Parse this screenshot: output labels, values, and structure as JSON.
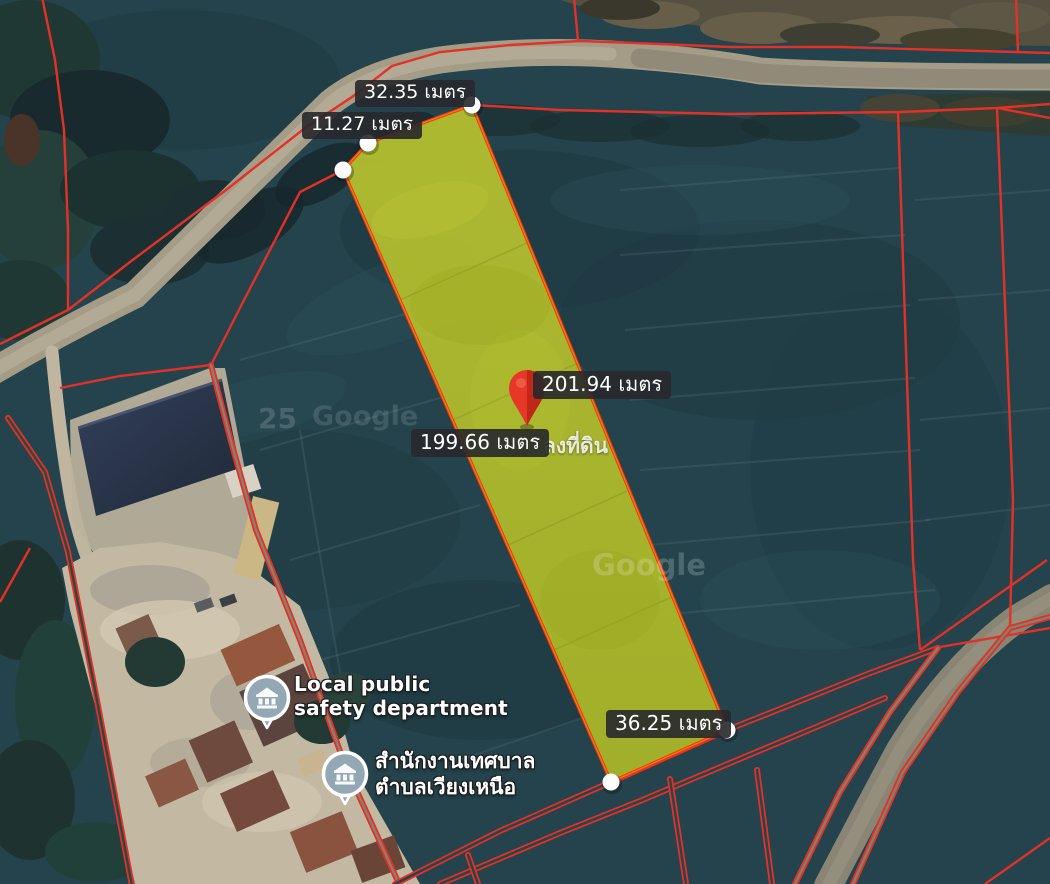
{
  "map": {
    "parcel": {
      "fill_color": "#adb92b",
      "border_color": "#ee3a13",
      "edge_labels": {
        "top": "32.35 เมตร",
        "top_left": "11.27 เมตร",
        "right": "201.94 เมตร",
        "left": "199.66 เมตร",
        "bottom": "36.25 เมตร"
      }
    },
    "marker": {
      "color": "#e73727"
    },
    "pois": [
      {
        "line1": "Local public",
        "line2": "safety department",
        "pin_color": "#93a7b4"
      },
      {
        "line1": "สำนักงานเทศบาล",
        "line2": "ตำบลเวียงเหนือ",
        "pin_color": "#93a7b4"
      }
    ],
    "watermarks": {
      "plot_text_partial": "ลงที่ดิน",
      "google": "Google",
      "year_fragment": "25"
    },
    "cadastral_line_color": "#e23127",
    "vertex_dot_color": "#ffffff",
    "label_style": {
      "bg": "#28282b",
      "fg": "#ffffff"
    },
    "terrain": {
      "field_color": "#24434c",
      "road_color": "#a59c88"
    }
  }
}
